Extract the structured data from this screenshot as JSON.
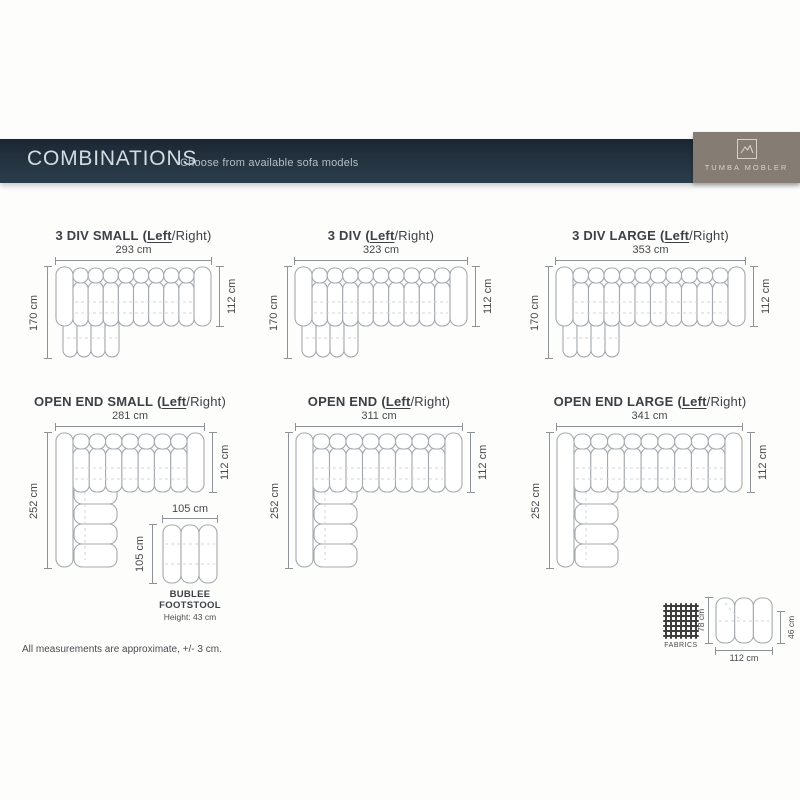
{
  "banner": {
    "title": "COMBINATIONS",
    "subtitle": "Choose from available sofa models"
  },
  "brand": {
    "name": "TUMBA MOBLER",
    "box_color": "#857d74",
    "banner_color": "#243441"
  },
  "side": {
    "open": "(",
    "left": "Left",
    "slash": "/",
    "right": "Right",
    "close": ")"
  },
  "diagrams": [
    {
      "title": "3 DIV SMALL",
      "width": "293 cm",
      "height": "170 cm",
      "depth": "112 cm"
    },
    {
      "title": "3 DIV",
      "width": "323 cm",
      "height": "170 cm",
      "depth": "112 cm"
    },
    {
      "title": "3 DIV LARGE",
      "width": "353 cm",
      "height": "170 cm",
      "depth": "112 cm"
    },
    {
      "title": "OPEN END SMALL",
      "width": "281 cm",
      "height": "252 cm",
      "depth": "112 cm"
    },
    {
      "title": "OPEN END",
      "width": "311 cm",
      "height": "252 cm",
      "depth": "112 cm"
    },
    {
      "title": "OPEN END LARGE",
      "width": "341 cm",
      "height": "252 cm",
      "depth": "112 cm"
    }
  ],
  "footstool": {
    "name_line1": "BUBLEE",
    "name_line2": "FOOTSTOOL",
    "height_note": "Height: 43 cm",
    "width": "105 cm",
    "depth": "105 cm"
  },
  "module": {
    "width": "112 cm",
    "depth": "78 cm",
    "seat_depth": "46 cm"
  },
  "fabric": {
    "label": "FABRICS"
  },
  "footnote": "All measurements are approximate, +/- 3 cm."
}
